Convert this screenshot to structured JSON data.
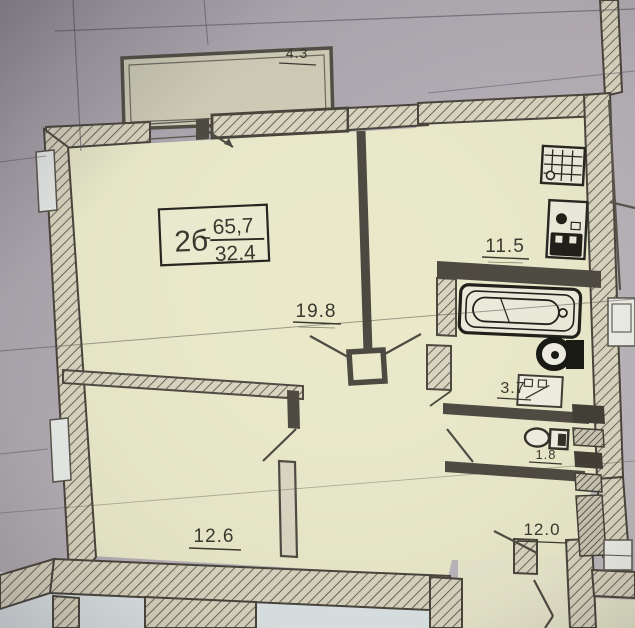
{
  "plan": {
    "stamp": {
      "type_label": "2б",
      "total_area": "65,7",
      "living_area": "32.4"
    },
    "rooms": {
      "balcony": {
        "area": "4.3"
      },
      "living_room": {
        "area": "19.8"
      },
      "kitchen": {
        "area": "11.5"
      },
      "bathroom": {
        "area": "3.7"
      },
      "toilet": {
        "area": "1.8"
      },
      "bedroom": {
        "area": "12.6"
      },
      "hall": {
        "area": "12.0"
      }
    },
    "fixtures": [
      "bathtub-icon",
      "toilet-bold-icon",
      "washing-machine-icon",
      "kitchen-sink-icon",
      "stove-oven-icon",
      "toilet-compact-icon",
      "ventilation-shaft-icon"
    ],
    "colors": {
      "paper": "#aca7ae",
      "room_fill": "#e9e9ca",
      "wall_hatch_fill": "#d8d4bf",
      "wall_line": "#4b4840",
      "ink": "#38362c",
      "below_plan": "#dce4e6"
    }
  }
}
